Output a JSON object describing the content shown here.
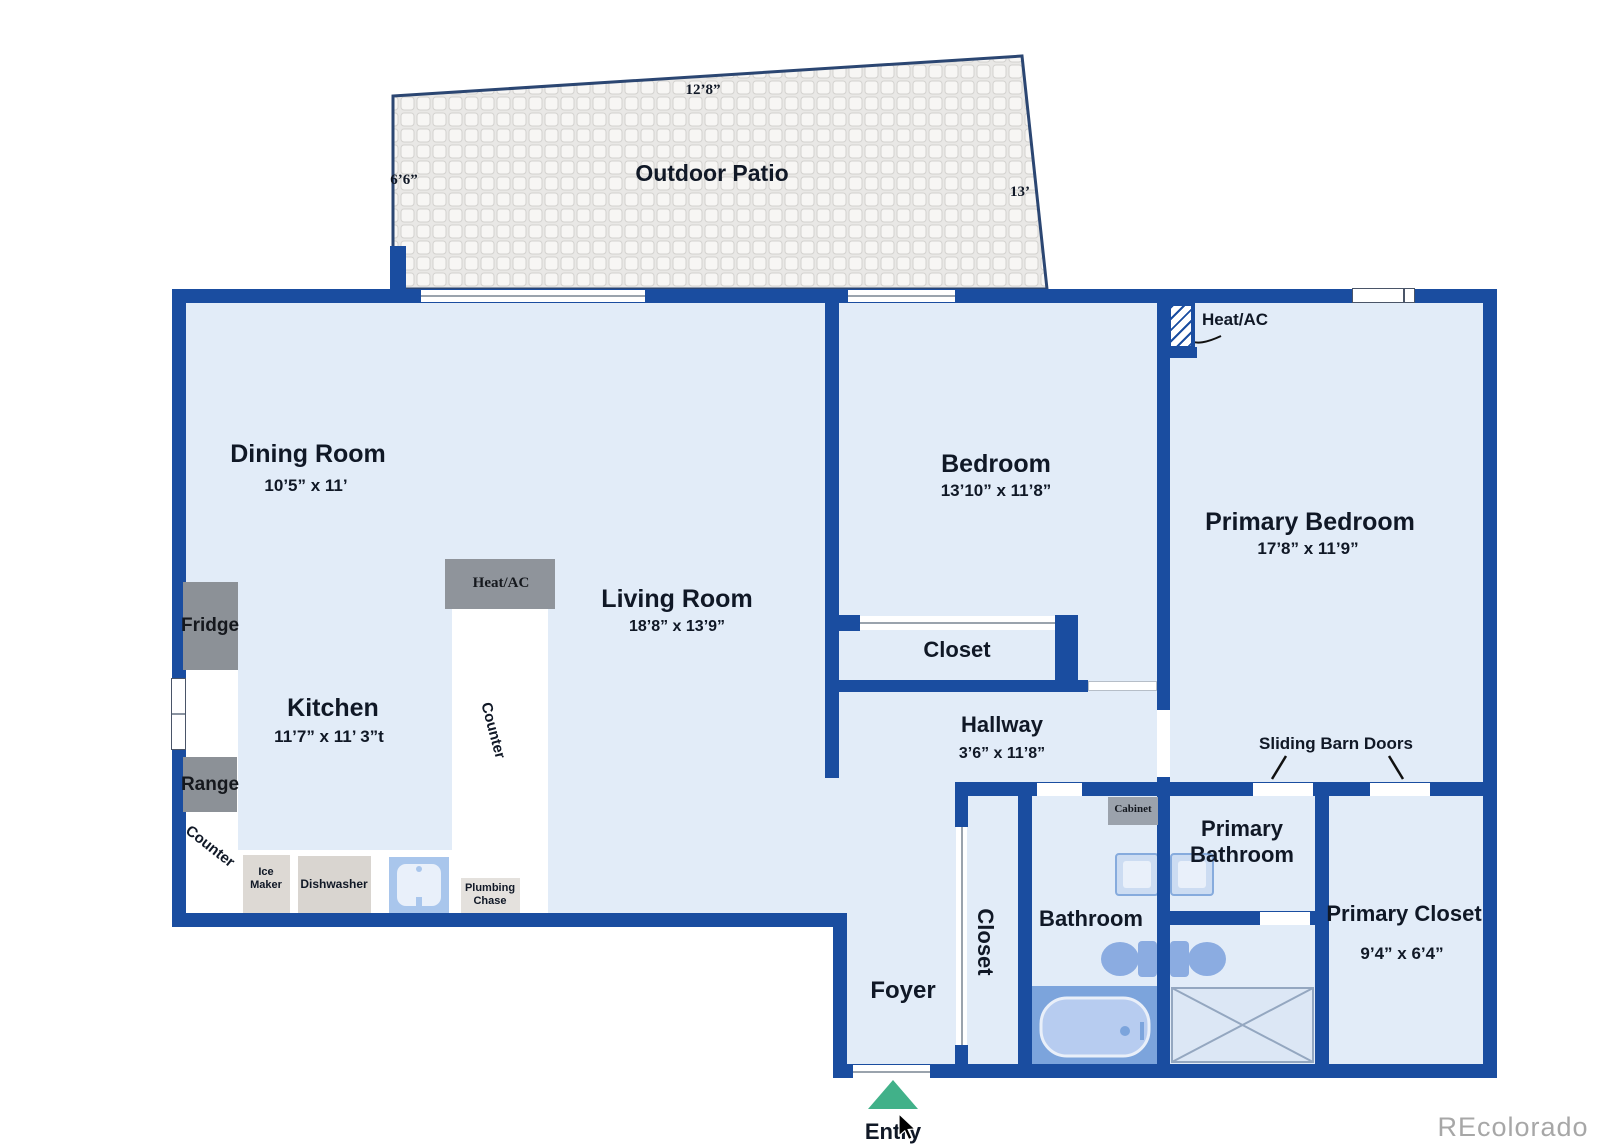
{
  "patio": {
    "name": "Outdoor Patio",
    "dim_top": "12’8”",
    "dim_left": "6’6”",
    "dim_right": "13’"
  },
  "rooms": {
    "dining": {
      "name": "Dining Room",
      "dims": "10’5” x 11’"
    },
    "kitchen": {
      "name": "Kitchen",
      "dims": "11’7” x 11’ 3”t"
    },
    "living": {
      "name": "Living Room",
      "dims": "18’8” x 13’9”"
    },
    "bedroom": {
      "name": "Bedroom",
      "dims": "13’10” x 11’8”"
    },
    "primary_bedroom": {
      "name": "Primary Bedroom",
      "dims": "17’8” x 11’9”"
    },
    "hallway": {
      "name": "Hallway",
      "dims": "3’6” x 11’8”"
    },
    "bedroom_closet": {
      "name": "Closet"
    },
    "foyer": {
      "name": "Foyer"
    },
    "foyer_closet": {
      "name": "Closet"
    },
    "bathroom": {
      "name": "Bathroom"
    },
    "primary_bathroom": {
      "line1": "Primary",
      "line2": "Bathroom"
    },
    "primary_closet": {
      "name": "Primary Closet",
      "dims": "9’4” x 6’4”"
    }
  },
  "fixtures": {
    "heat_ac_kitchen": "Heat/AC",
    "heat_ac_bedroom": "Heat/AC",
    "fridge": "Fridge",
    "range": "Range",
    "counter_left": "Counter",
    "counter_island": "Counter",
    "ice_maker_line1": "Ice",
    "ice_maker_line2": "Maker",
    "dishwasher": "Dishwasher",
    "plumbing_chase_line1": "Plumbing",
    "plumbing_chase_line2": "Chase",
    "cabinet": "Cabinet"
  },
  "annotations": {
    "sliding_barn_doors": "Sliding Barn Doors",
    "entry": "Entry",
    "watermark": "REcolorado"
  },
  "icons": {
    "entry_marker": "triangle-up",
    "cursor": "mouse-pointer",
    "toilets": "toilet-icon",
    "sinks": "sink-icon",
    "bathtub": "bathtub-icon",
    "shower": "shower-x-icon"
  },
  "colors": {
    "wall": "#1a4da0",
    "floor": "#e2ecf8",
    "accent_green": "#41b189"
  }
}
